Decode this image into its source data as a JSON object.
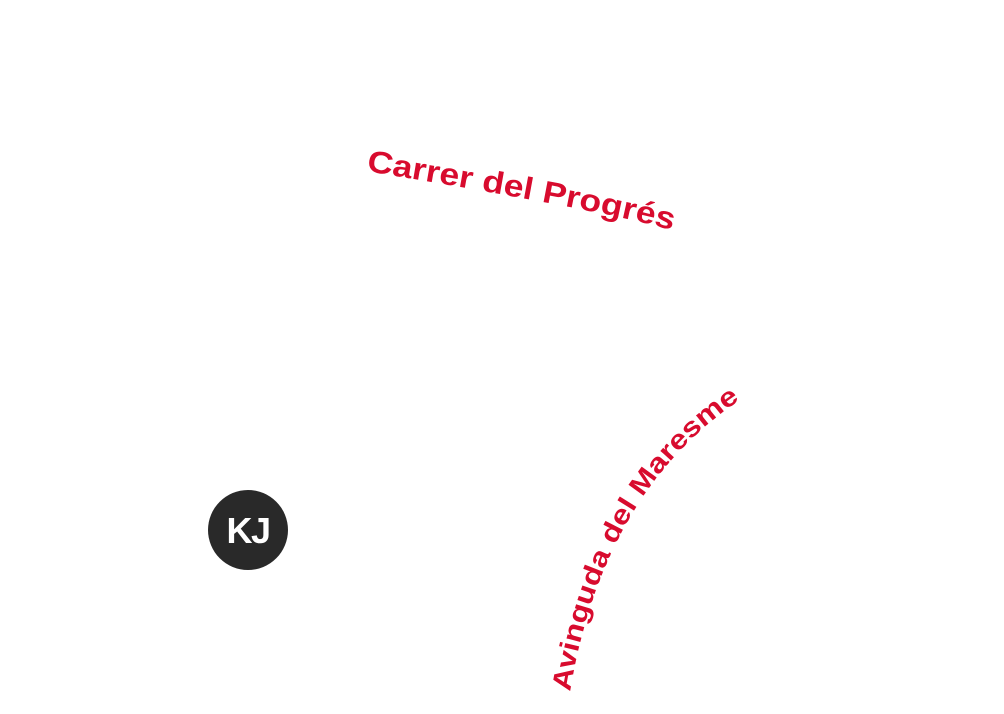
{
  "map": {
    "background_color": "#ffffff",
    "street_label_color": "#d80b2e",
    "streets": [
      {
        "label": "Carrer del Progrés"
      },
      {
        "label": "Avinguda del Maresme"
      }
    ],
    "marker": {
      "label": "KJ",
      "fill_color": "#292929",
      "text_color": "#ffffff"
    }
  }
}
